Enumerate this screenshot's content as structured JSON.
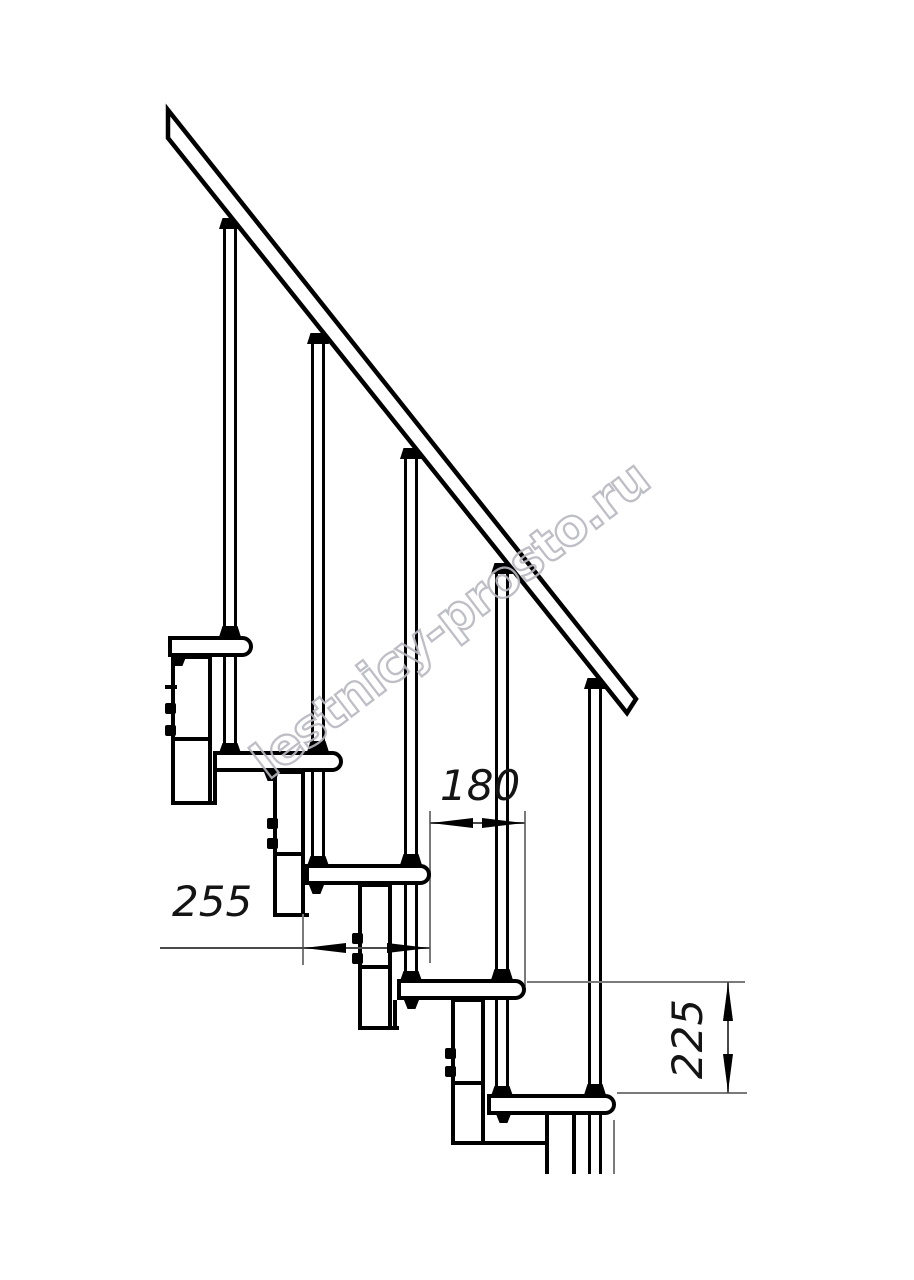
{
  "drawing": {
    "kind": "modular-staircase side elevation drawing",
    "watermark": {
      "text": "lestnicy-prosto.ru"
    },
    "dims": {
      "d180": {
        "label": "180"
      },
      "d255": {
        "label": "255"
      },
      "d225": {
        "label": "225"
      }
    },
    "structure": {
      "treads_visible": 5,
      "balusters_visible": 5
    },
    "colors": {
      "ink": "#000000",
      "dim_thin_line": "#7a7a7a",
      "watermark_outline": "#b8b8c0",
      "background": "#ffffff"
    }
  }
}
